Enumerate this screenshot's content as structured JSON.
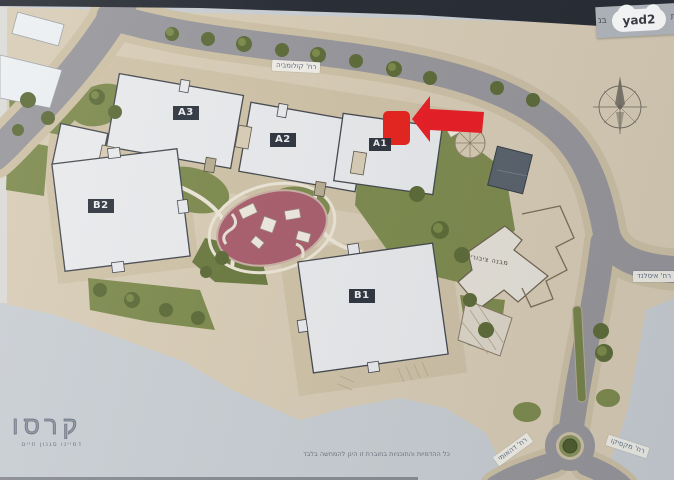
{
  "header": {
    "brand": "yad2",
    "plate_fragment_right": "ות",
    "plate_fragment_left": "בנ",
    "top_strip_color": "#272b33"
  },
  "map": {
    "buildings": [
      {
        "label": "A3"
      },
      {
        "label": "A2"
      },
      {
        "label": "A1"
      },
      {
        "label": "B2"
      },
      {
        "label": "B1"
      }
    ],
    "public_building_label": "מבנה ציבורי",
    "streets": [
      {
        "name": "רח' קולומביה"
      },
      {
        "name": "רח' איסלנד"
      },
      {
        "name": "רח' דהאומי"
      },
      {
        "name": "רח' מקסיקו"
      }
    ],
    "icons": {
      "compass": "compass-rose",
      "highlight": "red-arrow-and-unit-marker"
    },
    "colors": {
      "paper": "#c9ced3",
      "plan_ground": "#d8ccb5",
      "road": "#97969b",
      "green": "#7d8a4d",
      "playground": "#a95e6c",
      "building_roof": "#e9eaec",
      "marker_red": "#e8231d"
    }
  },
  "footer": {
    "developer": "קרסו",
    "tagline": "דמיינו סגנון חיים",
    "disclaimer": "כל ההדמיות והתוכניות בחוברת זו הינן להמחשה בלבד"
  }
}
